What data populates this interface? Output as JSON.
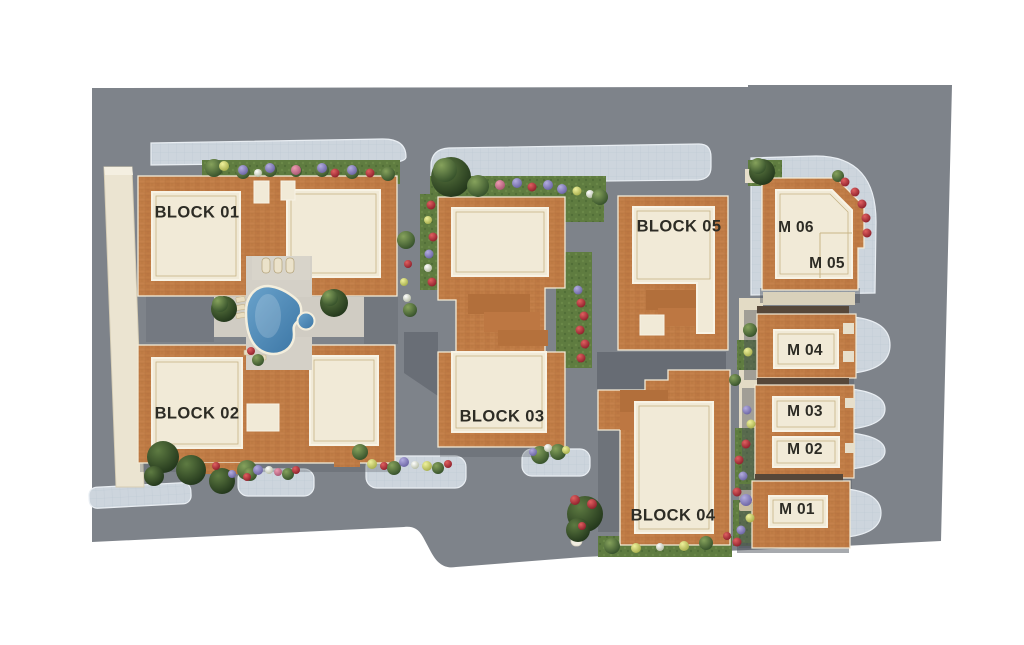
{
  "site_plan": {
    "description": "Aerial 3D master site plan of a residential complex with apartment blocks, villa row, pool courtyard and landscaped walkways",
    "blocks": [
      {
        "id": "block-01",
        "label": "BLOCK 01"
      },
      {
        "id": "block-02",
        "label": "BLOCK 02"
      },
      {
        "id": "block-03",
        "label": "BLOCK 03"
      },
      {
        "id": "block-04",
        "label": "BLOCK 04"
      },
      {
        "id": "block-05",
        "label": "BLOCK 05"
      }
    ],
    "villas": [
      {
        "id": "m-06",
        "label": "M 06"
      },
      {
        "id": "m-05",
        "label": "M 05"
      },
      {
        "id": "m-04",
        "label": "M 04"
      },
      {
        "id": "m-03",
        "label": "M 03"
      },
      {
        "id": "m-02",
        "label": "M 02"
      },
      {
        "id": "m-01",
        "label": "M 01"
      }
    ],
    "features": [
      "swimming-pool",
      "spa-pool",
      "landscaped-gardens",
      "paved-walkways",
      "boundary-wall"
    ],
    "colors": {
      "ground": "#7e838a",
      "pavement_tiles": "#cdd5dd",
      "brick_roof": "#c17d46",
      "roof_panel_cream": "#f1ead7",
      "grass": "#5f7c40",
      "pool_water": "#4c86b4",
      "boundary_wall": "#ebe4d1",
      "shadow": "#50555d",
      "label_text": "#2d2c25",
      "background": "#ffffff"
    }
  }
}
